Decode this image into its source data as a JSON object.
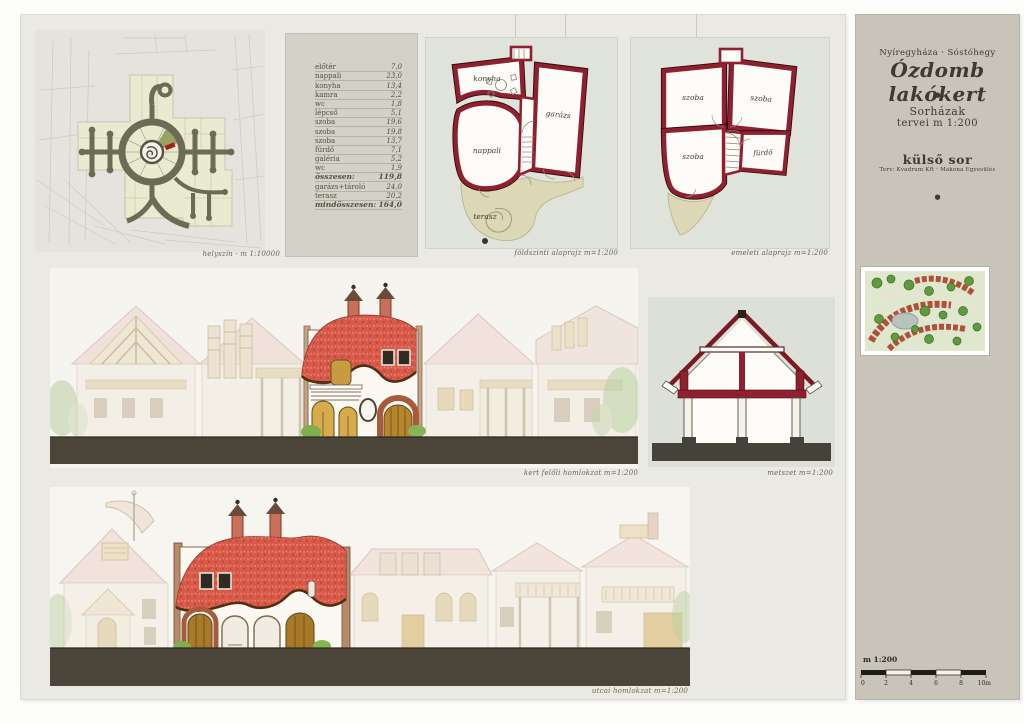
{
  "board": {
    "site_plan": {
      "caption": "helyszín · m 1:10000"
    },
    "area_table": {
      "rows": [
        {
          "label": "előtér",
          "value": "7,0"
        },
        {
          "label": "nappali",
          "value": "23,0"
        },
        {
          "label": "konyha",
          "value": "13,4"
        },
        {
          "label": "kamra",
          "value": "2,2"
        },
        {
          "label": "wc",
          "value": "1,8"
        },
        {
          "label": "lépcső",
          "value": "5,1"
        },
        {
          "label": "szoba",
          "value": "19,6"
        },
        {
          "label": "szoba",
          "value": "19,8"
        },
        {
          "label": "szoba",
          "value": "13,7"
        },
        {
          "label": "fürdő",
          "value": "7,1"
        },
        {
          "label": "galéria",
          "value": "5,2"
        },
        {
          "label": "wc",
          "value": "1,9"
        },
        {
          "label": "összesen:",
          "value": "119,8"
        },
        {
          "label": "garázs+tároló",
          "value": "24,0"
        },
        {
          "label": "terasz",
          "value": "20,2"
        },
        {
          "label": "mindösszesen:",
          "value": "164,0"
        }
      ]
    },
    "ground_floor": {
      "caption": "földszinti alaprajz  m=1:200",
      "labels": {
        "konyha": "konyha",
        "garazs": "garázs",
        "nappali": "nappali",
        "terasz": "terasz"
      }
    },
    "upper_floor": {
      "caption": "emeleti alaprajz  m=1:200",
      "labels": {
        "szoba1": "szoba",
        "szoba2": "szoba",
        "szoba3": "szoba",
        "furdo": "fürdő"
      }
    },
    "garden_elevation": {
      "caption": "kert felőli homlokzat  m=1:200"
    },
    "section": {
      "caption": "metszet  m=1:200"
    },
    "street_elevation": {
      "caption": "utcai homlokzat  m=1:200"
    }
  },
  "title_block": {
    "location": "Nyíregyháza · Sóstóhegy",
    "title": "Ózdomb lakókert",
    "bullet": "●",
    "series_line1": "Sorházak",
    "series_line2": "tervei  m 1:200",
    "row_name": "külső sor",
    "credits": "Terv: Kvadrum Kft · Makona Egyesülés"
  },
  "scale_bar": {
    "label": "m 1:200",
    "ticks": [
      "0",
      "2",
      "4",
      "6",
      "8",
      "10m"
    ]
  },
  "colors": {
    "wall_red": "#8e2030",
    "roof_red": "#d85a4b",
    "ground_dark": "#4a4538",
    "terrace_beige": "#dcd7b4",
    "road_olive": "#6c6b56",
    "parcel_green": "#e9ebd0",
    "board_bg": "#ebe9e3",
    "sidebar_bg": "#c8c4b9"
  }
}
